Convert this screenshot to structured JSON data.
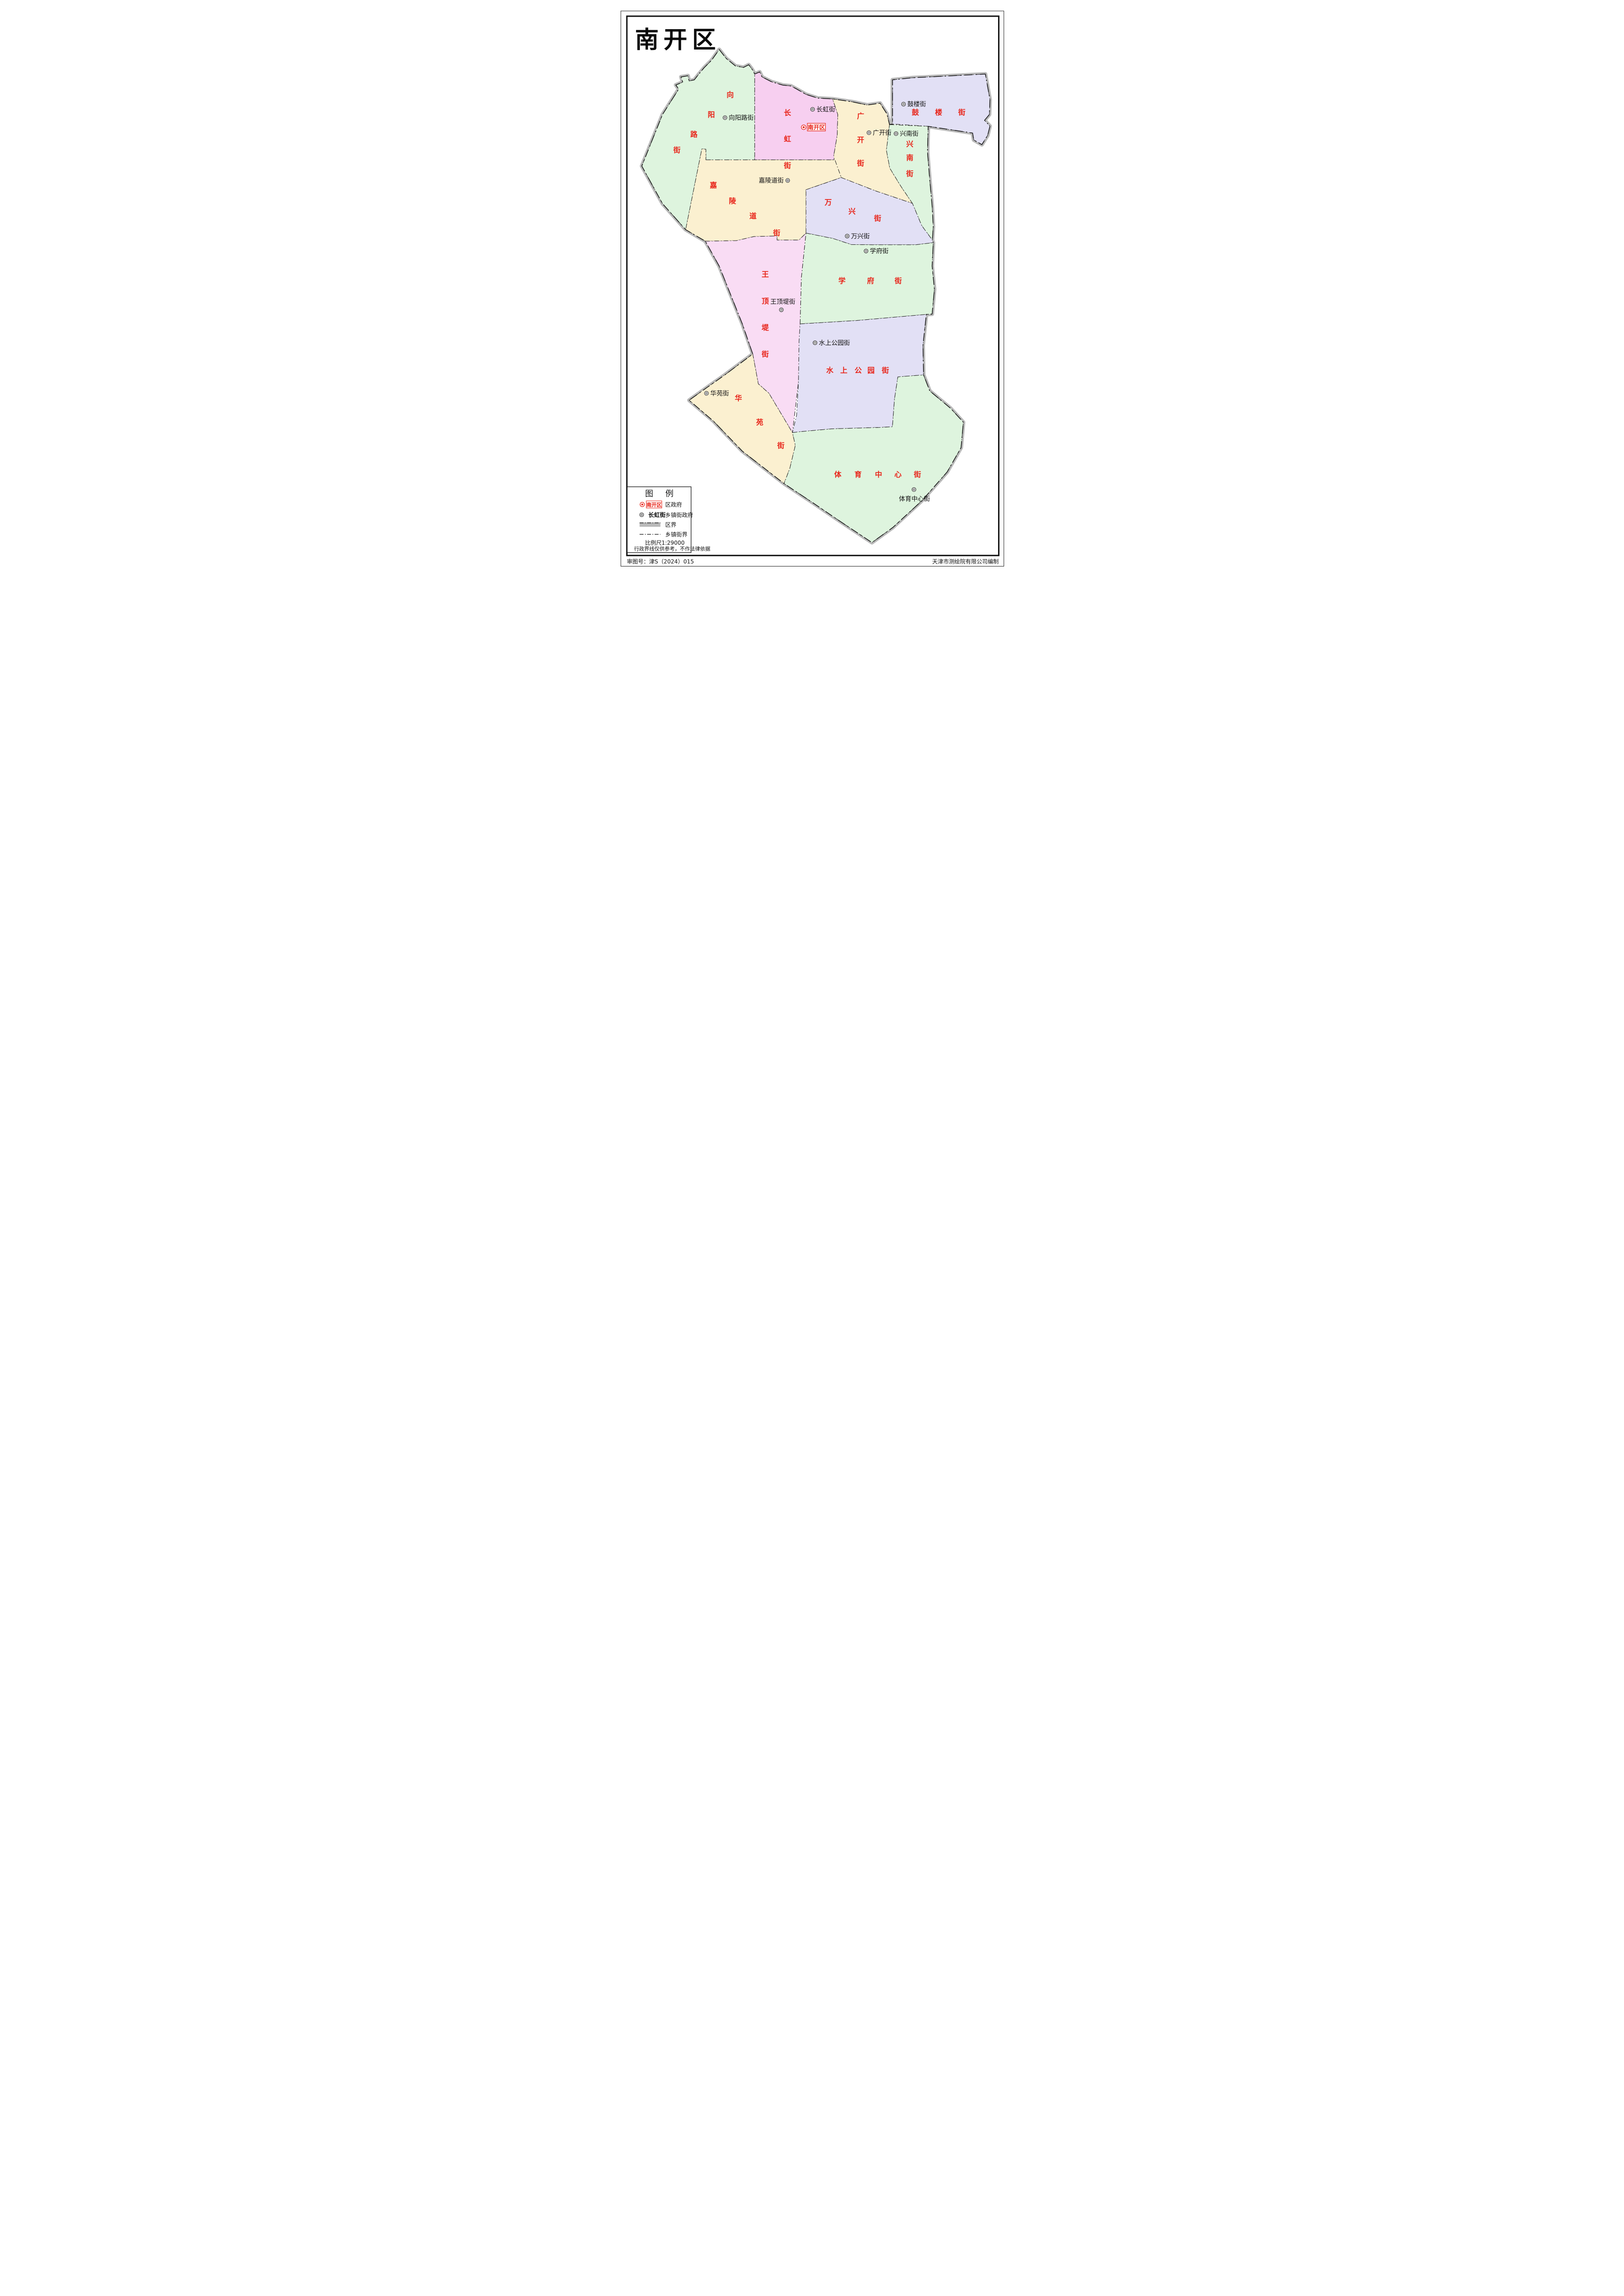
{
  "title": "南开区",
  "district_marker": "南开区",
  "colors": {
    "green": "#def4de",
    "pink": "#f7cff0",
    "pink2": "#f9dcf4",
    "cream": "#fbf0d0",
    "lavender": "#e2e0f5",
    "red": "#e8251a",
    "boundary_black": "#1a1a1a",
    "district_band": "#b9b9b9"
  },
  "regions": [
    {
      "name": "向阳路街",
      "fill": "green"
    },
    {
      "name": "长虹街",
      "fill": "pink"
    },
    {
      "name": "广开街",
      "fill": "cream"
    },
    {
      "name": "鼓楼街",
      "fill": "lavender"
    },
    {
      "name": "兴南街",
      "fill": "green"
    },
    {
      "name": "嘉陵道街",
      "fill": "cream"
    },
    {
      "name": "万兴街",
      "fill": "lavender"
    },
    {
      "name": "学府街",
      "fill": "green"
    },
    {
      "name": "王顶堤街",
      "fill": "pink2"
    },
    {
      "name": "水上公园街",
      "fill": "lavender"
    },
    {
      "name": "华苑街",
      "fill": "cream"
    },
    {
      "name": "体育中心街",
      "fill": "green"
    }
  ],
  "legend": {
    "title": "图例",
    "rows": [
      {
        "sample": "南开区",
        "label": "区政府"
      },
      {
        "sample": "长虹街",
        "label": "乡镇街政府"
      },
      {
        "sample": "",
        "label": "区界"
      },
      {
        "sample": "",
        "label": "乡镇街界"
      }
    ],
    "scale_label": "比例尺",
    "scale_value": "1:29000",
    "note": "行政界线仅供参考，不作法律依据"
  },
  "footer": {
    "left": "审图号：津S（2024）015",
    "right": "天津市测绘院有限公司编制"
  }
}
